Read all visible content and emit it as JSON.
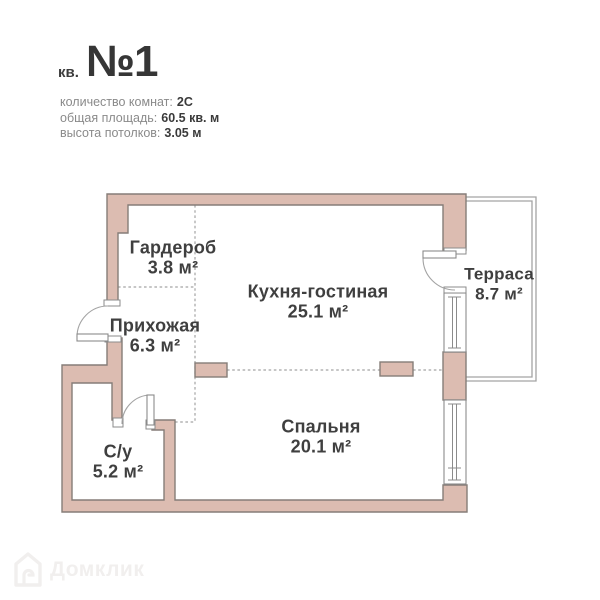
{
  "header": {
    "apartment_prefix": "кв.",
    "apartment_number": "№1",
    "info": [
      {
        "label": "количество комнат:",
        "value": "2С"
      },
      {
        "label": "общая площадь:",
        "value": "60.5 кв. м"
      },
      {
        "label": "высота потолков:",
        "value": "3.05 м"
      }
    ]
  },
  "floorplan": {
    "rooms": [
      {
        "id": "wardrobe",
        "name": "Гардероб",
        "area": "3.8 м²"
      },
      {
        "id": "kitchen_living",
        "name": "Кухня-гостиная",
        "area": "25.1 м²"
      },
      {
        "id": "terrace",
        "name": "Терраса",
        "area": "8.7 м²"
      },
      {
        "id": "hallway",
        "name": "Прихожая",
        "area": "6.3 м²"
      },
      {
        "id": "bathroom",
        "name": "С/у",
        "area": "5.2 м²"
      },
      {
        "id": "bedroom",
        "name": "Спальня",
        "area": "20.1 м²"
      }
    ],
    "colors": {
      "wall_fill": "#dcbcb1",
      "wall_stroke": "#857d78",
      "thin_line": "#a3a3a3",
      "label_text": "#3f3f3f"
    }
  },
  "watermark": {
    "text": "Домклик"
  }
}
